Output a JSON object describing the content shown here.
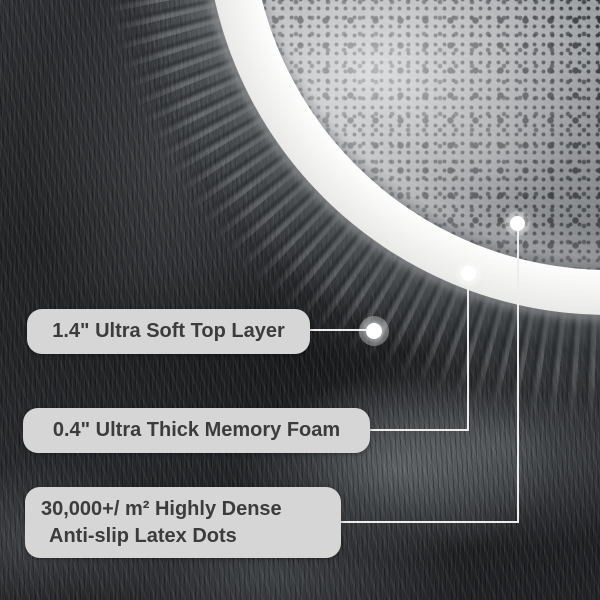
{
  "image": {
    "type": "product-feature-photo",
    "subject": "folded plush grey rug showing top fur layer, white memory-foam edge and dotted anti-slip backing"
  },
  "callouts": [
    {
      "id": "top-layer",
      "text": "1.4\" Ultra Soft Top Layer"
    },
    {
      "id": "memory-foam",
      "text": "0.4\" Ultra Thick Memory Foam"
    },
    {
      "id": "latex-dots",
      "line1": "30,000+/ m² Highly Dense",
      "line2": "Anti-slip Latex Dots"
    }
  ],
  "colors": {
    "label_bg": "#d6d6d6",
    "label_text": "#3c3c3c",
    "leader_line": "#ededed",
    "marker": "#ffffff",
    "foam_edge": "#f5f5f4",
    "backing_base": "#9b9ea1",
    "backing_dots": "#26292c",
    "fur_dark": "#1d1f21",
    "fur_light": "#7e8286"
  }
}
